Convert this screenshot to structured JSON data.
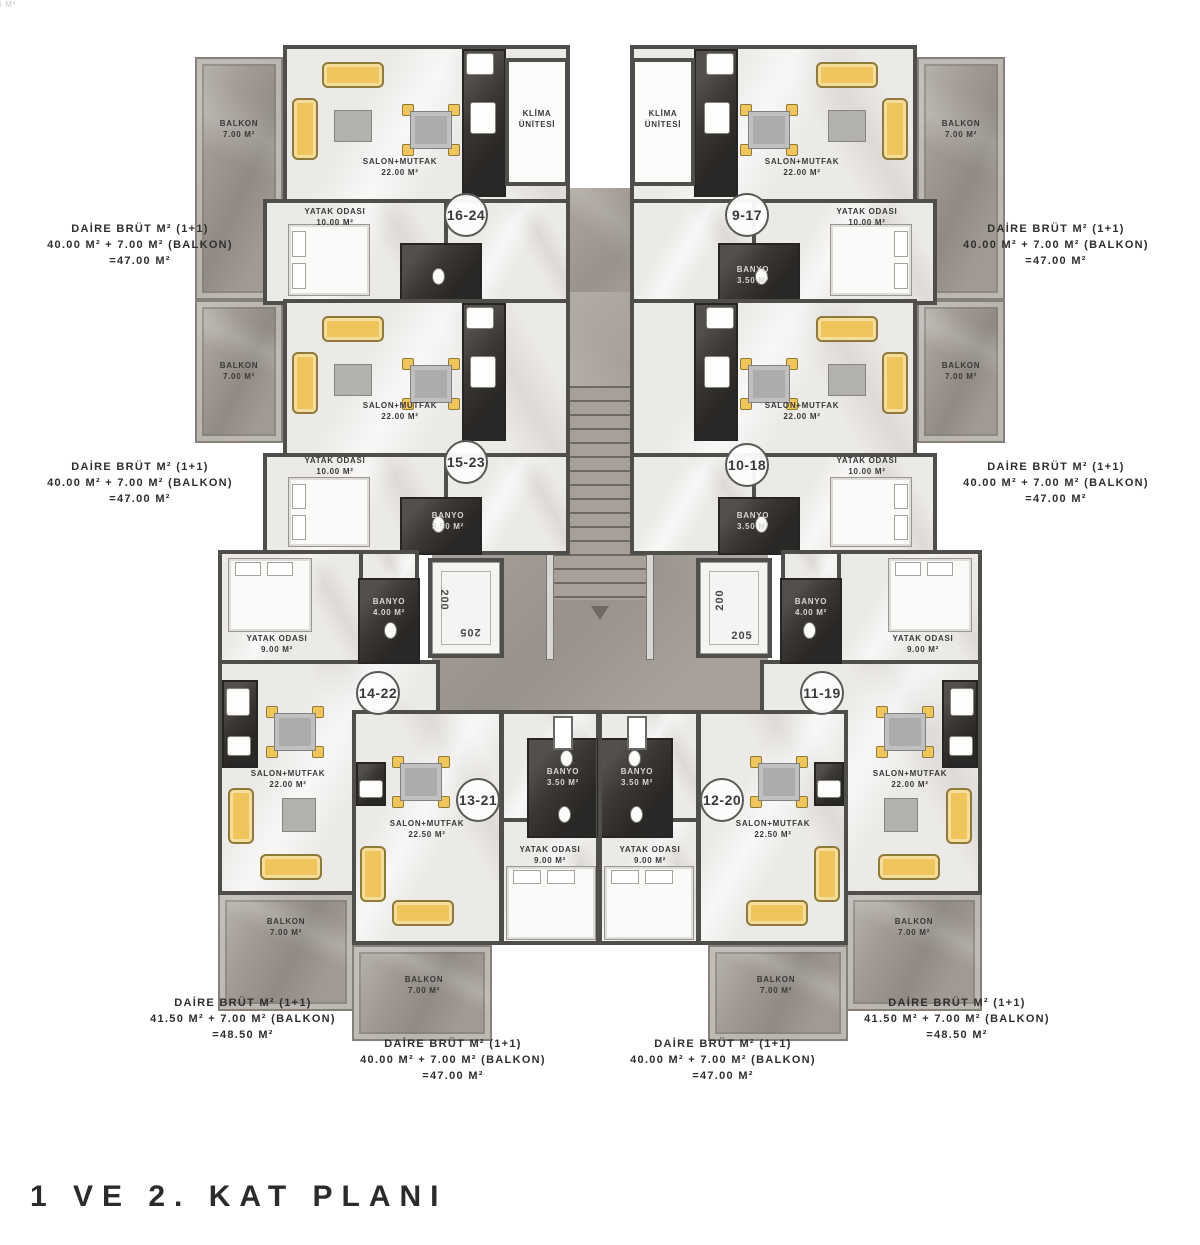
{
  "title": "1 VE 2. KAT PLANI",
  "units": {
    "u16_24": "16-24",
    "u9_17": "9-17",
    "u15_23": "15-23",
    "u10_18": "10-18",
    "u14_22": "14-22",
    "u11_19": "11-19",
    "u13_21": "13-21",
    "u12_20": "12-20"
  },
  "rooms": {
    "salon": {
      "name": "SALON+MUTFAK",
      "area": "22.00 M²"
    },
    "salon_big": {
      "name": "SALON+MUTFAK",
      "area": "22.50 M²"
    },
    "bedroom10": {
      "name": "YATAK ODASI",
      "area": "10.00 M²"
    },
    "bedroom9": {
      "name": "YATAK ODASI",
      "area": "9.00 M²"
    },
    "bath35": {
      "name": "BANYO",
      "area": "3.50 M²"
    },
    "bath4": {
      "name": "BANYO",
      "area": "4.00 M²"
    },
    "balcony": {
      "name": "BALKON",
      "area": "7.00 M²"
    },
    "klima": {
      "line1": "KLİMA",
      "line2": "ÜNİTESİ"
    }
  },
  "elevator": {
    "num_top": "200",
    "num_bottom": "205"
  },
  "area_labels": {
    "standard": {
      "l1": "DAİRE BRÜT M² (1+1)",
      "l2": "40.00 M² + 7.00 M² (BALKON)",
      "l3": "=47.00 M²"
    },
    "large": {
      "l1": "DAİRE BRÜT M² (1+1)",
      "l2": "41.50 M² + 7.00 M² (BALKON)",
      "l3": "=48.50 M²"
    }
  },
  "colors": {
    "marble_dark": "#a19a93",
    "room_light": "#eceae7",
    "wall": "#504e4b",
    "tile_dark": "#3a3734",
    "furniture_yellow": "#f0c65c",
    "text": "#3a3938"
  }
}
